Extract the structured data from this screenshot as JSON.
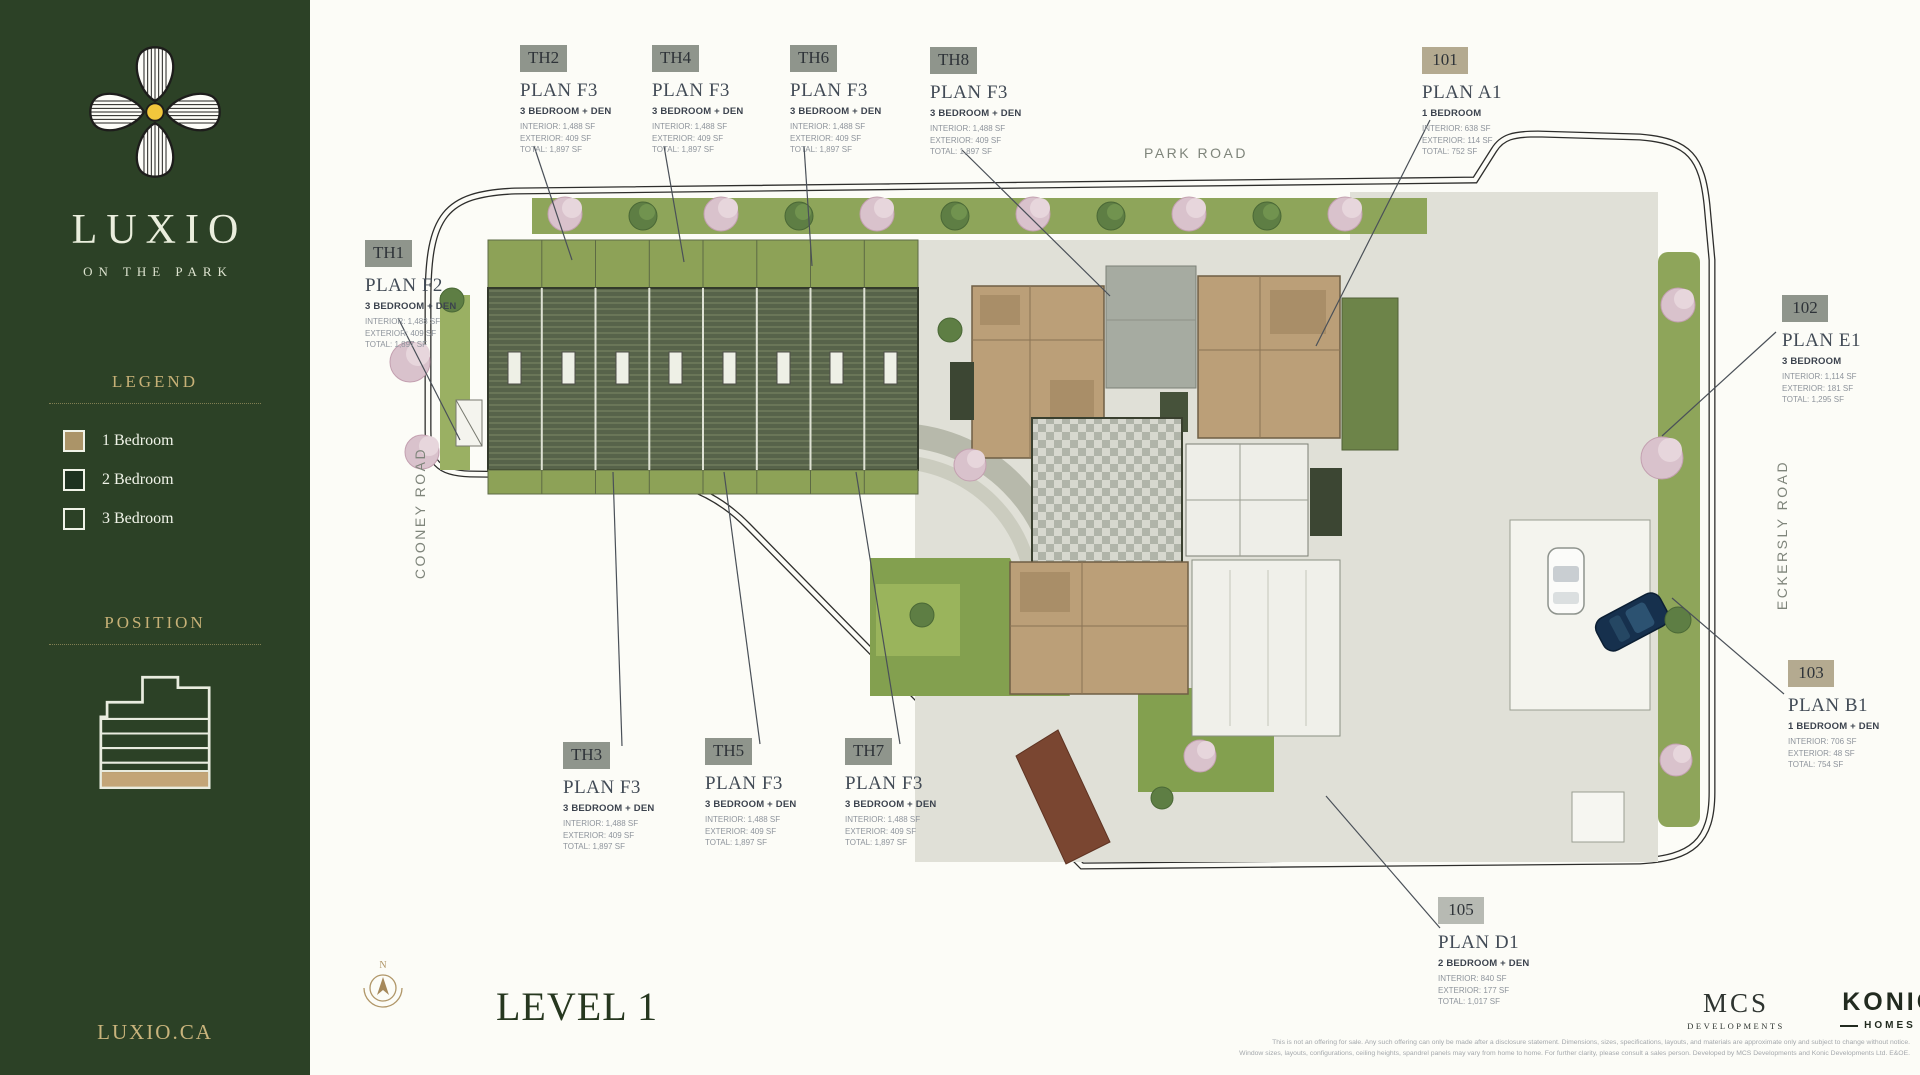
{
  "sidebar": {
    "brand": {
      "name": "LUXIO",
      "tagline": "ON THE PARK",
      "website": "LUXIO.CA"
    },
    "legend": {
      "title": "LEGEND",
      "items": [
        {
          "label": "1 Bedroom",
          "color": "#ab9468"
        },
        {
          "label": "2 Bedroom",
          "color": "#1e3220"
        },
        {
          "label": "3 Bedroom",
          "color": "transparent"
        }
      ]
    },
    "position": {
      "title": "POSITION",
      "highlight_floor_color": "#c3a577"
    }
  },
  "plan": {
    "level_title": "LEVEL 1",
    "compass_label": "N",
    "roads": {
      "top": "PARK ROAD",
      "left": "COONEY ROAD",
      "right": "ECKERSLY ROAD"
    }
  },
  "units": [
    {
      "id": "TH1",
      "plan": "PLAN F2",
      "type": "3 BEDROOM + DEN",
      "interior": "INTERIOR: 1,488 SF",
      "exterior": "EXTERIOR: 409 SF",
      "total": "TOTAL: 1,897 SF",
      "badge_color": "#8f958c"
    },
    {
      "id": "TH2",
      "plan": "PLAN F3",
      "type": "3 BEDROOM + DEN",
      "interior": "INTERIOR: 1,488 SF",
      "exterior": "EXTERIOR: 409 SF",
      "total": "TOTAL: 1,897 SF",
      "badge_color": "#8f958c"
    },
    {
      "id": "TH3",
      "plan": "PLAN F3",
      "type": "3 BEDROOM + DEN",
      "interior": "INTERIOR: 1,488 SF",
      "exterior": "EXTERIOR: 409 SF",
      "total": "TOTAL: 1,897 SF",
      "badge_color": "#8f958c"
    },
    {
      "id": "TH4",
      "plan": "PLAN F3",
      "type": "3 BEDROOM + DEN",
      "interior": "INTERIOR: 1,488 SF",
      "exterior": "EXTERIOR: 409 SF",
      "total": "TOTAL: 1,897 SF",
      "badge_color": "#8f958c"
    },
    {
      "id": "TH5",
      "plan": "PLAN F3",
      "type": "3 BEDROOM + DEN",
      "interior": "INTERIOR: 1,488 SF",
      "exterior": "EXTERIOR: 409 SF",
      "total": "TOTAL: 1,897 SF",
      "badge_color": "#8f958c"
    },
    {
      "id": "TH6",
      "plan": "PLAN F3",
      "type": "3 BEDROOM + DEN",
      "interior": "INTERIOR: 1,488 SF",
      "exterior": "EXTERIOR: 409 SF",
      "total": "TOTAL: 1,897 SF",
      "badge_color": "#8f958c"
    },
    {
      "id": "TH7",
      "plan": "PLAN F3",
      "type": "3 BEDROOM + DEN",
      "interior": "INTERIOR: 1,488 SF",
      "exterior": "EXTERIOR: 409 SF",
      "total": "TOTAL: 1,897 SF",
      "badge_color": "#8f958c"
    },
    {
      "id": "TH8",
      "plan": "PLAN F3",
      "type": "3 BEDROOM + DEN",
      "interior": "INTERIOR: 1,488 SF",
      "exterior": "EXTERIOR: 409 SF",
      "total": "TOTAL: 1,897 SF",
      "badge_color": "#8f958c"
    },
    {
      "id": "101",
      "plan": "PLAN A1",
      "type": "1 BEDROOM",
      "interior": "INTERIOR: 638 SF",
      "exterior": "EXTERIOR: 114 SF",
      "total": "TOTAL: 752 SF",
      "badge_color": "#b4aa90"
    },
    {
      "id": "102",
      "plan": "PLAN E1",
      "type": "3 BEDROOM",
      "interior": "INTERIOR: 1,114 SF",
      "exterior": "EXTERIOR: 181 SF",
      "total": "TOTAL: 1,295 SF",
      "badge_color": "#8f958c"
    },
    {
      "id": "103",
      "plan": "PLAN B1",
      "type": "1 BEDROOM + DEN",
      "interior": "INTERIOR: 706 SF",
      "exterior": "EXTERIOR: 48 SF",
      "total": "TOTAL: 754 SF",
      "badge_color": "#b4aa90"
    },
    {
      "id": "105",
      "plan": "PLAN D1",
      "type": "2 BEDROOM + DEN",
      "interior": "INTERIOR: 840 SF",
      "exterior": "EXTERIOR: 177 SF",
      "total": "TOTAL: 1,017 SF",
      "badge_color": "#b7bab3"
    }
  ],
  "footer": {
    "mcs_name": "MCS",
    "mcs_sub": "DEVELOPMENTS",
    "konic_name": "KONIC",
    "konic_sub": "HOMES",
    "disclaimer_line1": "This is not an offering for sale. Any such offering can only be made after a disclosure statement. Dimensions, sizes, specifications, layouts, and materials are approximate only and subject to change without notice.",
    "disclaimer_line2": "Window sizes, layouts, configurations, ceiling heights, spandrel panels may vary from home to home. For further clarity, please consult a sales person. Developed by MCS Developments and Konic Developments Ltd. E&OE."
  }
}
